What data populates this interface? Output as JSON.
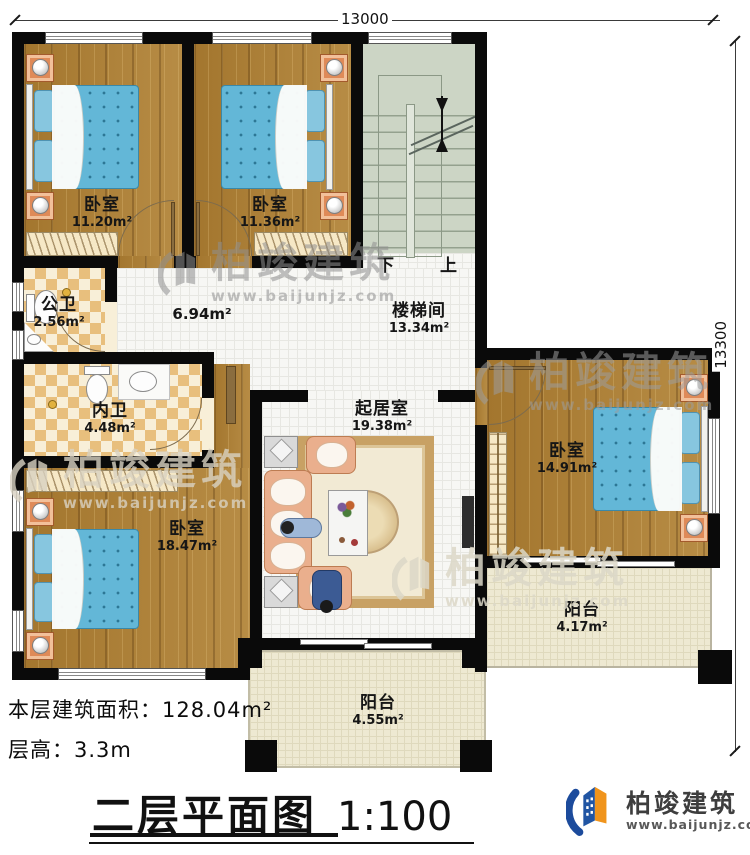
{
  "dim_top": "13000",
  "dim_right": "13300",
  "rooms": {
    "bedroom1": {
      "name": "卧室",
      "area": "11.20m²"
    },
    "bedroom2": {
      "name": "卧室",
      "area": "11.36m²"
    },
    "stairwell": {
      "name": "楼梯间",
      "area": "13.34m²"
    },
    "hall": {
      "area": "6.94m²"
    },
    "public_bath": {
      "name": "公卫",
      "area": "2.56m²"
    },
    "inner_bath": {
      "name": "内卫",
      "area": "4.48m²"
    },
    "living": {
      "name": "起居室",
      "area": "19.38m²"
    },
    "bedroom3": {
      "name": "卧室",
      "area": "18.47m²"
    },
    "bedroom4": {
      "name": "卧室",
      "area": "14.91m²"
    },
    "balcony_right": {
      "name": "阳台",
      "area": "4.17m²"
    },
    "balcony_bottom": {
      "name": "阳台",
      "area": "4.55m²"
    }
  },
  "stairs": {
    "down_label": "下",
    "up_label": "上"
  },
  "footer": {
    "area_label": "本层建筑面积：",
    "area_value": "128.04m²",
    "height_label": "层高：",
    "height_value": "3.3m",
    "title": "二层平面图",
    "scale": "1:100"
  },
  "brand": {
    "name": "柏竣建筑",
    "site": "www.baijunjz.com"
  },
  "colors": {
    "wall": "#0a0a0a",
    "wood_floor": "#a97e38",
    "tile_floor": "#f7f7f4",
    "stair_floor": "#ccd5c5",
    "balcony_floor": "#eee9d2",
    "bath_checker_dark": "#e8bf7d",
    "bath_checker_light": "#f8efd8",
    "bed_blue": "#63b7d7",
    "sofa_peach": "#eaaf8d",
    "brand_blue": "#1c4b9c",
    "brand_orange": "#f0941c"
  }
}
